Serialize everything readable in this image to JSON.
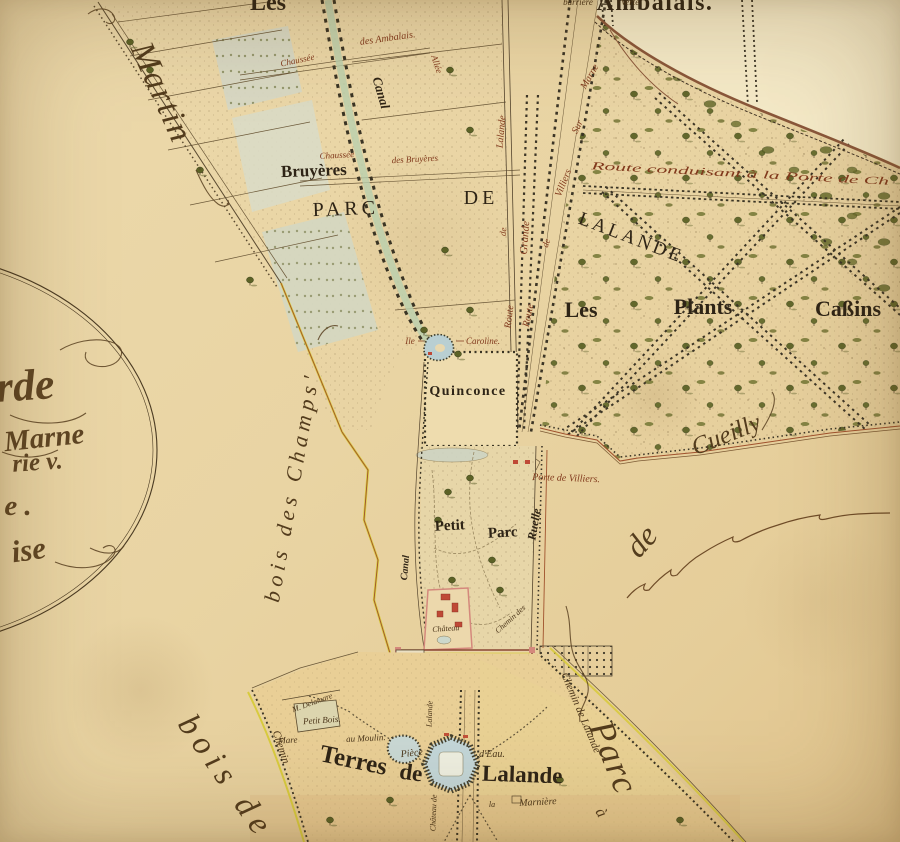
{
  "map": {
    "kind": "antique-estate-plan",
    "palette": {
      "paper": "#ead7a8",
      "paper_light": "#f5ebcb",
      "paper_warm": "#e9cf96",
      "ink": "#32271a",
      "ink_red": "#81391c",
      "water": "#bfd4d6",
      "canal_green": "#b9cfae",
      "tree_green": "#5c6226",
      "road_dark": "#3a3424",
      "boundary_red": "#a0522d",
      "edging_yellow": "#d8cb3e",
      "building_red": "#bf4936",
      "wall_pink": "#d4887c",
      "tint_blue": "#d7d9c6"
    }
  },
  "map_labels": [
    {
      "id": "les",
      "text": "Les",
      "x": 268,
      "y": 10,
      "rot": 0,
      "size": 24,
      "cls": "area"
    },
    {
      "id": "ambalais",
      "text": "Ambalais.",
      "x": 655,
      "y": 10,
      "rot": 0,
      "size": 24,
      "cls": "area ls1"
    },
    {
      "id": "bruyeres",
      "text": "Bruyères",
      "x": 314,
      "y": 176,
      "rot": -2,
      "size": 17,
      "cls": "area"
    },
    {
      "id": "parc-word",
      "text": "PARC",
      "x": 346,
      "y": 215,
      "rot": -2,
      "size": 20,
      "cls": "caps"
    },
    {
      "id": "de-word",
      "text": "DE",
      "x": 481,
      "y": 204,
      "rot": 0,
      "size": 20,
      "cls": "caps"
    },
    {
      "id": "lalande-word",
      "text": "LALANDE",
      "x": 629,
      "y": 243,
      "rot": 21,
      "size": 19,
      "cls": "caps2"
    },
    {
      "id": "les-plants",
      "text": "Les",
      "x": 581,
      "y": 317,
      "rot": 0,
      "size": 22,
      "cls": "area"
    },
    {
      "id": "plants",
      "text": "Plants",
      "x": 703,
      "y": 314,
      "rot": 0,
      "size": 22,
      "cls": "area"
    },
    {
      "id": "cassins",
      "text": "Caßins",
      "x": 848,
      "y": 316,
      "rot": 0,
      "size": 22,
      "cls": "area"
    },
    {
      "id": "quinconce",
      "text": "Quinconce",
      "x": 468,
      "y": 395,
      "rot": 0,
      "size": 14,
      "cls": "area ls1"
    },
    {
      "id": "ile",
      "text": "Ile",
      "x": 410,
      "y": 344,
      "rot": 0,
      "size": 9,
      "cls": "itred"
    },
    {
      "id": "caroline",
      "text": "Caroline.",
      "x": 483,
      "y": 344,
      "rot": 0,
      "size": 9,
      "cls": "itred"
    },
    {
      "id": "petit",
      "text": "Petit",
      "x": 450,
      "y": 530,
      "rot": -3,
      "size": 15,
      "cls": "area"
    },
    {
      "id": "petit-parc-word",
      "text": "Parc",
      "x": 503,
      "y": 537,
      "rot": -3,
      "size": 15,
      "cls": "area"
    },
    {
      "id": "porte-villiers",
      "text": "Porte de Villiers.",
      "x": 566,
      "y": 481,
      "rot": 2,
      "size": 10,
      "cls": "itred"
    },
    {
      "id": "ruelle",
      "text": "Ruelle",
      "x": 538,
      "y": 525,
      "rot": -80,
      "size": 12,
      "cls": "boldit"
    },
    {
      "id": "terres",
      "text": "Terres",
      "x": 352,
      "y": 768,
      "rot": 12,
      "size": 25,
      "cls": "area"
    },
    {
      "id": "terres-de",
      "text": "de",
      "x": 410,
      "y": 780,
      "rot": 8,
      "size": 23,
      "cls": "area"
    },
    {
      "id": "terres-lalande",
      "text": "Lalande",
      "x": 522,
      "y": 782,
      "rot": 2,
      "size": 23,
      "cls": "area"
    },
    {
      "id": "piece",
      "text": "Pièce",
      "x": 412,
      "y": 756,
      "rot": -6,
      "size": 10,
      "cls": "it"
    },
    {
      "id": "deau",
      "text": "d'Eau.",
      "x": 492,
      "y": 757,
      "rot": 0,
      "size": 10,
      "cls": "it"
    },
    {
      "id": "la-marniere-la",
      "text": "la",
      "x": 492,
      "y": 807,
      "rot": 0,
      "size": 8,
      "cls": "it"
    },
    {
      "id": "marniere",
      "text": "Marnière",
      "x": 538,
      "y": 805,
      "rot": -3,
      "size": 10,
      "cls": "it"
    },
    {
      "id": "mare",
      "text": "Mare",
      "x": 288,
      "y": 743,
      "rot": -3,
      "size": 9,
      "cls": "it"
    },
    {
      "id": "au-moulin",
      "text": "au Moulin.",
      "x": 366,
      "y": 741,
      "rot": -3,
      "size": 9,
      "cls": "it"
    },
    {
      "id": "delamare",
      "text": "M. Delamare",
      "x": 313,
      "y": 705,
      "rot": -20,
      "size": 8,
      "cls": "it"
    },
    {
      "id": "petit-bois",
      "text": "Petit Bois.",
      "x": 322,
      "y": 723,
      "rot": -4,
      "size": 9,
      "cls": "it"
    },
    {
      "id": "chemin-sw",
      "text": "Chemin",
      "x": 278,
      "y": 748,
      "rot": 72,
      "size": 11,
      "cls": "it"
    },
    {
      "id": "chemin-lalande",
      "text": "Chemin de Lalande",
      "x": 578,
      "y": 714,
      "rot": 67,
      "size": 11,
      "cls": "it"
    },
    {
      "id": "chateau-de-vert",
      "text": "Château de",
      "x": 436,
      "y": 813,
      "rot": -88,
      "size": 8,
      "cls": "it"
    },
    {
      "id": "lalande-vert",
      "text": "Lalande",
      "x": 432,
      "y": 714,
      "rot": -88,
      "size": 8,
      "cls": "it"
    },
    {
      "id": "chateau",
      "text": "Château",
      "x": 446,
      "y": 631,
      "rot": -4,
      "size": 8,
      "cls": "it"
    },
    {
      "id": "chemin-des",
      "text": "Chemin des",
      "x": 512,
      "y": 621,
      "rot": -42,
      "size": 8,
      "cls": "it"
    },
    {
      "id": "route-conduisant",
      "text": "Route conduisant à la Porte de Ch",
      "x": 740,
      "y": 177,
      "rot": 3,
      "size": 11,
      "cls": "itred",
      "tl": 298
    },
    {
      "id": "barriere",
      "text": "barrière",
      "x": 578,
      "y": 5,
      "rot": 0,
      "size": 9,
      "cls": "it"
    },
    {
      "id": "verte",
      "text": "Verte",
      "x": 630,
      "y": 5,
      "rot": 0,
      "size": 9,
      "cls": "it"
    },
    {
      "id": "chaussee-ambalais",
      "text": "Chaussée",
      "x": 298,
      "y": 63,
      "rot": -12,
      "size": 9,
      "cls": "itred"
    },
    {
      "id": "des-ambalais",
      "text": "des Ambalais.",
      "x": 388,
      "y": 41,
      "rot": -8,
      "size": 10,
      "cls": "itred"
    },
    {
      "id": "chaussee-bruyeres",
      "text": "Chaussée",
      "x": 337,
      "y": 158,
      "rot": -3,
      "size": 9,
      "cls": "itred"
    },
    {
      "id": "des-bruyeres",
      "text": "des Bruyères",
      "x": 415,
      "y": 162,
      "rot": -3,
      "size": 9,
      "cls": "itred"
    },
    {
      "id": "canal-top",
      "text": "Canal",
      "x": 377,
      "y": 94,
      "rot": 74,
      "size": 13,
      "cls": "boldit"
    },
    {
      "id": "allee",
      "text": "Allée",
      "x": 434,
      "y": 65,
      "rot": 72,
      "size": 9,
      "cls": "itred"
    },
    {
      "id": "canal-west",
      "text": "Canal",
      "x": 408,
      "y": 568,
      "rot": -85,
      "size": 10,
      "cls": "boldit"
    },
    {
      "id": "grande",
      "text": "Grande",
      "x": 528,
      "y": 238,
      "rot": -86,
      "size": 11,
      "cls": "itred"
    },
    {
      "id": "rdl-lalande",
      "text": "Lalande",
      "x": 504,
      "y": 132,
      "rot": -85,
      "size": 10,
      "cls": "itred"
    },
    {
      "id": "rdl-de",
      "text": "de",
      "x": 506,
      "y": 232,
      "rot": -85,
      "size": 9,
      "cls": "itred"
    },
    {
      "id": "rdl-route",
      "text": "Route",
      "x": 512,
      "y": 317,
      "rot": -83,
      "size": 10,
      "cls": "itred"
    },
    {
      "id": "rvm-marne",
      "text": "Marne",
      "x": 592,
      "y": 78,
      "rot": -60,
      "size": 10,
      "cls": "itred"
    },
    {
      "id": "rvm-sur",
      "text": "Sur",
      "x": 580,
      "y": 128,
      "rot": -64,
      "size": 10,
      "cls": "itred"
    },
    {
      "id": "rvm-villiers",
      "text": "Villiers",
      "x": 566,
      "y": 184,
      "rot": -68,
      "size": 10,
      "cls": "itred"
    },
    {
      "id": "rvm-de",
      "text": "de",
      "x": 549,
      "y": 244,
      "rot": -72,
      "size": 9,
      "cls": "itred"
    },
    {
      "id": "rvm-route",
      "text": "Route",
      "x": 531,
      "y": 316,
      "rot": -78,
      "size": 10,
      "cls": "itred"
    },
    {
      "id": "martin",
      "text": "Martin",
      "x": 152,
      "y": 97,
      "rot": 66,
      "size": 34,
      "cls": "script ls2"
    },
    {
      "id": "bois-des-champs",
      "text": "bois des Champs'",
      "x": 299,
      "y": 488,
      "rot": -80,
      "size": 22,
      "cls": "script ls4"
    },
    {
      "id": "cueilly-de",
      "text": "de",
      "x": 649,
      "y": 548,
      "rot": -48,
      "size": 32,
      "cls": "script"
    },
    {
      "id": "cueilly",
      "text": "Cueilly",
      "x": 729,
      "y": 442,
      "rot": -22,
      "size": 25,
      "cls": "script"
    },
    {
      "id": "bois-de",
      "text": "bois de",
      "x": 218,
      "y": 783,
      "rot": 55,
      "size": 33,
      "cls": "script ls6"
    },
    {
      "id": "parc-script",
      "text": "Parc",
      "x": 603,
      "y": 762,
      "rot": 68,
      "size": 36,
      "cls": "script ls2"
    },
    {
      "id": "a-script",
      "text": "à",
      "x": 597,
      "y": 815,
      "rot": 60,
      "size": 16,
      "cls": "script"
    },
    {
      "id": "cart-rde",
      "text": "rde",
      "x": 26,
      "y": 400,
      "rot": -4,
      "size": 44,
      "cls": "cart"
    },
    {
      "id": "cart-marne",
      "text": "Marne",
      "x": 45,
      "y": 447,
      "rot": -6,
      "size": 29,
      "cls": "cart"
    },
    {
      "id": "cart-rie",
      "text": "rie v.",
      "x": 38,
      "y": 470,
      "rot": -4,
      "size": 25,
      "cls": "cart"
    },
    {
      "id": "cart-e",
      "text": "e .",
      "x": 18,
      "y": 515,
      "rot": 0,
      "size": 29,
      "cls": "cart"
    },
    {
      "id": "cart-ise",
      "text": "ise",
      "x": 30,
      "y": 560,
      "rot": -8,
      "size": 31,
      "cls": "cart"
    }
  ]
}
